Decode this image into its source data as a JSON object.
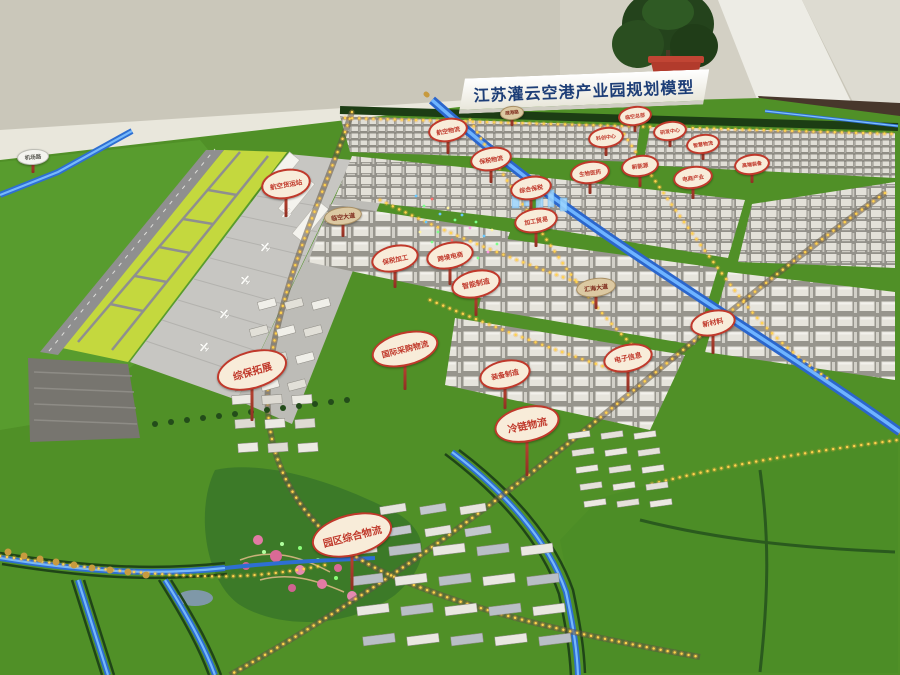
{
  "scene": {
    "title_sign": "江苏灌云空港产业园规划模型",
    "palette": {
      "wall": "#c9c6b9",
      "pillar": "#edece5",
      "floor": "#47372b",
      "grass": "#509027",
      "lawn": "#4c8d26",
      "park": "#3c7a28",
      "infield": "#c4d83e",
      "runway": "#8f8f8f",
      "apron": "#c7c6c2",
      "canal": "#2e6fd2",
      "canal_glow": "#7ec1ff",
      "street_light": "#ffd34d",
      "street_glow": "#f5a93c",
      "gold_tree": "#c89b3f",
      "hedge": "#1c3d14",
      "sign_red": "#c0392b",
      "sign_cream": "#f8ecd9",
      "flower": "#e27ba4",
      "plant_pot": "#b23b2c"
    },
    "signs": [
      {
        "kind": "zone",
        "text": "航空货运站",
        "x": 286,
        "y": 182,
        "w": 46,
        "h": 26,
        "fs": 6.5,
        "pole": 24,
        "rot": -10
      },
      {
        "kind": "road",
        "text": "临空大道",
        "x": 343,
        "y": 215,
        "w": 36,
        "h": 16,
        "fs": 6,
        "pole": 16,
        "rot": -8
      },
      {
        "kind": "zone",
        "text": "航空物流",
        "x": 448,
        "y": 128,
        "w": 36,
        "h": 20,
        "fs": 6,
        "pole": 18,
        "rot": -10
      },
      {
        "kind": "zone",
        "text": "保税物流",
        "x": 491,
        "y": 157,
        "w": 38,
        "h": 20,
        "fs": 6,
        "pole": 18,
        "rot": -10
      },
      {
        "kind": "zone",
        "text": "综合保税",
        "x": 531,
        "y": 186,
        "w": 38,
        "h": 20,
        "fs": 6,
        "pole": 18,
        "rot": -10
      },
      {
        "kind": "zone",
        "text": "加工贸易",
        "x": 536,
        "y": 218,
        "w": 40,
        "h": 21,
        "fs": 6,
        "pole": 20,
        "rot": -10
      },
      {
        "kind": "zone",
        "text": "生物医药",
        "x": 590,
        "y": 170,
        "w": 36,
        "h": 19,
        "fs": 5.5,
        "pole": 16,
        "rot": -8
      },
      {
        "kind": "zone",
        "text": "新能源",
        "x": 640,
        "y": 164,
        "w": 34,
        "h": 18,
        "fs": 5.5,
        "pole": 16,
        "rot": -8
      },
      {
        "kind": "zone",
        "text": "电商产业",
        "x": 693,
        "y": 175,
        "w": 36,
        "h": 19,
        "fs": 5.5,
        "pole": 16,
        "rot": -8
      },
      {
        "kind": "zone",
        "text": "科创中心",
        "x": 606,
        "y": 135,
        "w": 32,
        "h": 17,
        "fs": 5,
        "pole": 14,
        "rot": -8
      },
      {
        "kind": "zone",
        "text": "临空总部",
        "x": 635,
        "y": 114,
        "w": 30,
        "h": 16,
        "fs": 5,
        "pole": 12,
        "rot": -8
      },
      {
        "kind": "zone",
        "text": "研发中心",
        "x": 670,
        "y": 129,
        "w": 30,
        "h": 16,
        "fs": 5,
        "pole": 12,
        "rot": -8
      },
      {
        "kind": "zone",
        "text": "智慧物流",
        "x": 703,
        "y": 142,
        "w": 30,
        "h": 16,
        "fs": 5,
        "pole": 12,
        "rot": -8
      },
      {
        "kind": "zone",
        "text": "高端装备",
        "x": 752,
        "y": 162,
        "w": 32,
        "h": 17,
        "fs": 5,
        "pole": 14,
        "rot": -8
      },
      {
        "kind": "zone",
        "text": "电子信息",
        "x": 628,
        "y": 356,
        "w": 46,
        "h": 24,
        "fs": 7,
        "pole": 26,
        "rot": -12
      },
      {
        "kind": "zone",
        "text": "新材料",
        "x": 713,
        "y": 321,
        "w": 42,
        "h": 22,
        "fs": 7,
        "pole": 24,
        "rot": -12
      },
      {
        "kind": "road",
        "text": "汇海大道",
        "x": 596,
        "y": 286,
        "w": 38,
        "h": 17,
        "fs": 6,
        "pole": 16,
        "rot": -8
      },
      {
        "kind": "zone",
        "text": "国际采购物流",
        "x": 405,
        "y": 347,
        "w": 64,
        "h": 30,
        "fs": 8,
        "pole": 30,
        "rot": -14
      },
      {
        "kind": "zone",
        "text": "保税加工",
        "x": 395,
        "y": 256,
        "w": 44,
        "h": 23,
        "fs": 6.5,
        "pole": 22,
        "rot": -12
      },
      {
        "kind": "zone",
        "text": "跨境电商",
        "x": 450,
        "y": 253,
        "w": 44,
        "h": 23,
        "fs": 6.5,
        "pole": 22,
        "rot": -12
      },
      {
        "kind": "zone",
        "text": "智能制造",
        "x": 476,
        "y": 282,
        "w": 46,
        "h": 24,
        "fs": 7,
        "pole": 24,
        "rot": -12
      },
      {
        "kind": "zone",
        "text": "装备制造",
        "x": 505,
        "y": 372,
        "w": 48,
        "h": 25,
        "fs": 7,
        "pole": 26,
        "rot": -12
      },
      {
        "kind": "zone",
        "text": "综保拓展",
        "x": 252,
        "y": 368,
        "w": 68,
        "h": 34,
        "fs": 10,
        "pole": 38,
        "rot": -16
      },
      {
        "kind": "zone",
        "text": "园区综合物流",
        "x": 352,
        "y": 533,
        "w": 78,
        "h": 38,
        "fs": 10,
        "pole": 40,
        "rot": -14
      },
      {
        "kind": "zone",
        "text": "冷链物流",
        "x": 527,
        "y": 422,
        "w": 62,
        "h": 32,
        "fs": 10,
        "pole": 40,
        "rot": -12
      },
      {
        "kind": "white",
        "text": "机场路",
        "x": 33,
        "y": 156,
        "w": 30,
        "h": 14,
        "fs": 5.5,
        "pole": 12,
        "rot": -4
      },
      {
        "kind": "road",
        "text": "疏港路",
        "x": 512,
        "y": 112,
        "w": 22,
        "h": 12,
        "fs": 4.5,
        "pole": 10,
        "rot": -6
      }
    ]
  }
}
